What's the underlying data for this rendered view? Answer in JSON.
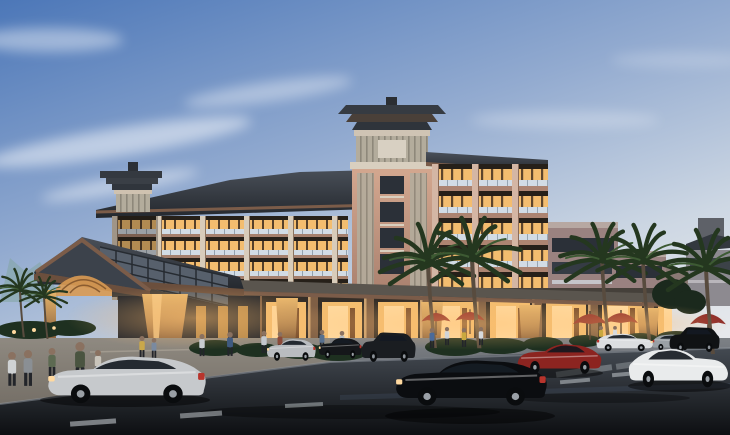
{
  "scene": {
    "caption": "Dusk architectural rendering of a multi-storey Asian-style resort hotel with a central pagoda tower, a gabled porte-cochere entrance canopy, warmly lit balconies and ground-floor retail arcade with red umbrellas, palm trees, pedestrians, and cars on a wet street in the foreground",
    "subject": "resort hotel exterior at dusk",
    "elements": {
      "building": "five-storey hotel block with pagoda-capped central tower and stepped right wing",
      "entrance": "gabled porte-cochere canopy with skylight grid and tapered lit columns",
      "arcade": "ground-floor retail colonnade with warm lighting",
      "tower": "central pagoda tower with layered eaves",
      "turret": "secondary pagoda turret on left roof",
      "distant_building": "low grey building at far right",
      "street": "wet asphalt road with lane dashes and crosswalk",
      "plaza": "entrance plaza with pedestrians"
    },
    "counts": {
      "umbrellas": 5,
      "palm_trees": 7,
      "pedestrians": 19,
      "vehicles": 9
    },
    "vehicles": [
      {
        "type": "sedan",
        "color_name": "silver",
        "position": "foreground left"
      },
      {
        "type": "sedan",
        "color_name": "black",
        "position": "foreground center"
      },
      {
        "type": "sports-car",
        "color_name": "red",
        "position": "center right"
      },
      {
        "type": "roadster",
        "color_name": "white",
        "position": "foreground right"
      },
      {
        "type": "sedan",
        "color_name": "silver",
        "position": "parked at curb"
      },
      {
        "type": "sedan",
        "color_name": "black",
        "position": "parked at curb"
      },
      {
        "type": "suv",
        "color_name": "black",
        "position": "parked center"
      },
      {
        "type": "sedan",
        "color_name": "white",
        "position": "right middle lane"
      },
      {
        "type": "suv",
        "color_name": "black",
        "position": "far right"
      }
    ]
  },
  "palette": {
    "sky_top": "#4c77b8",
    "sky_mid": "#93abd0",
    "sky_low": "#cdd7e3",
    "sky_horizon": "#e6e8ec",
    "cloud": "#ffffff",
    "mountain": "#7fa49e",
    "roof_dark": "#3e444d",
    "roof_edge": "#24282e",
    "fascia_brown": "#7b5c49",
    "facade_cream": "#d8ccba",
    "facade_pink": "#c49a88",
    "wall_mauve": "#9a8280",
    "parapet_light": "#b7a8a2",
    "panel_slat": "#b3ac9c",
    "window_dark": "#2b3038",
    "window_warm": "#f3bd6f",
    "window_bright": "#ffd99e",
    "railing_glass": "#d2dce5",
    "column_warm": "#e9b76d",
    "column_base": "#7a5336",
    "umbrella_red": "#8e2b28",
    "palm_dark": "#24371f",
    "palm_mid": "#3d5a33",
    "trunk_brown": "#584b3e",
    "hedge_green": "#1e3020",
    "plaza_warm": "#b39a78",
    "sidewalk_gray": "#7d8186",
    "road_top": "#444a52",
    "road_bottom": "#0d0f12",
    "lane_mark": "#cfd6da",
    "car_silver": "#c6c9cc",
    "car_black": "#0b0d10",
    "car_red": "#8c2420",
    "car_white": "#e9ebec",
    "distant_building": "#8d8a90",
    "glow_warm": "#ffbe6e"
  }
}
